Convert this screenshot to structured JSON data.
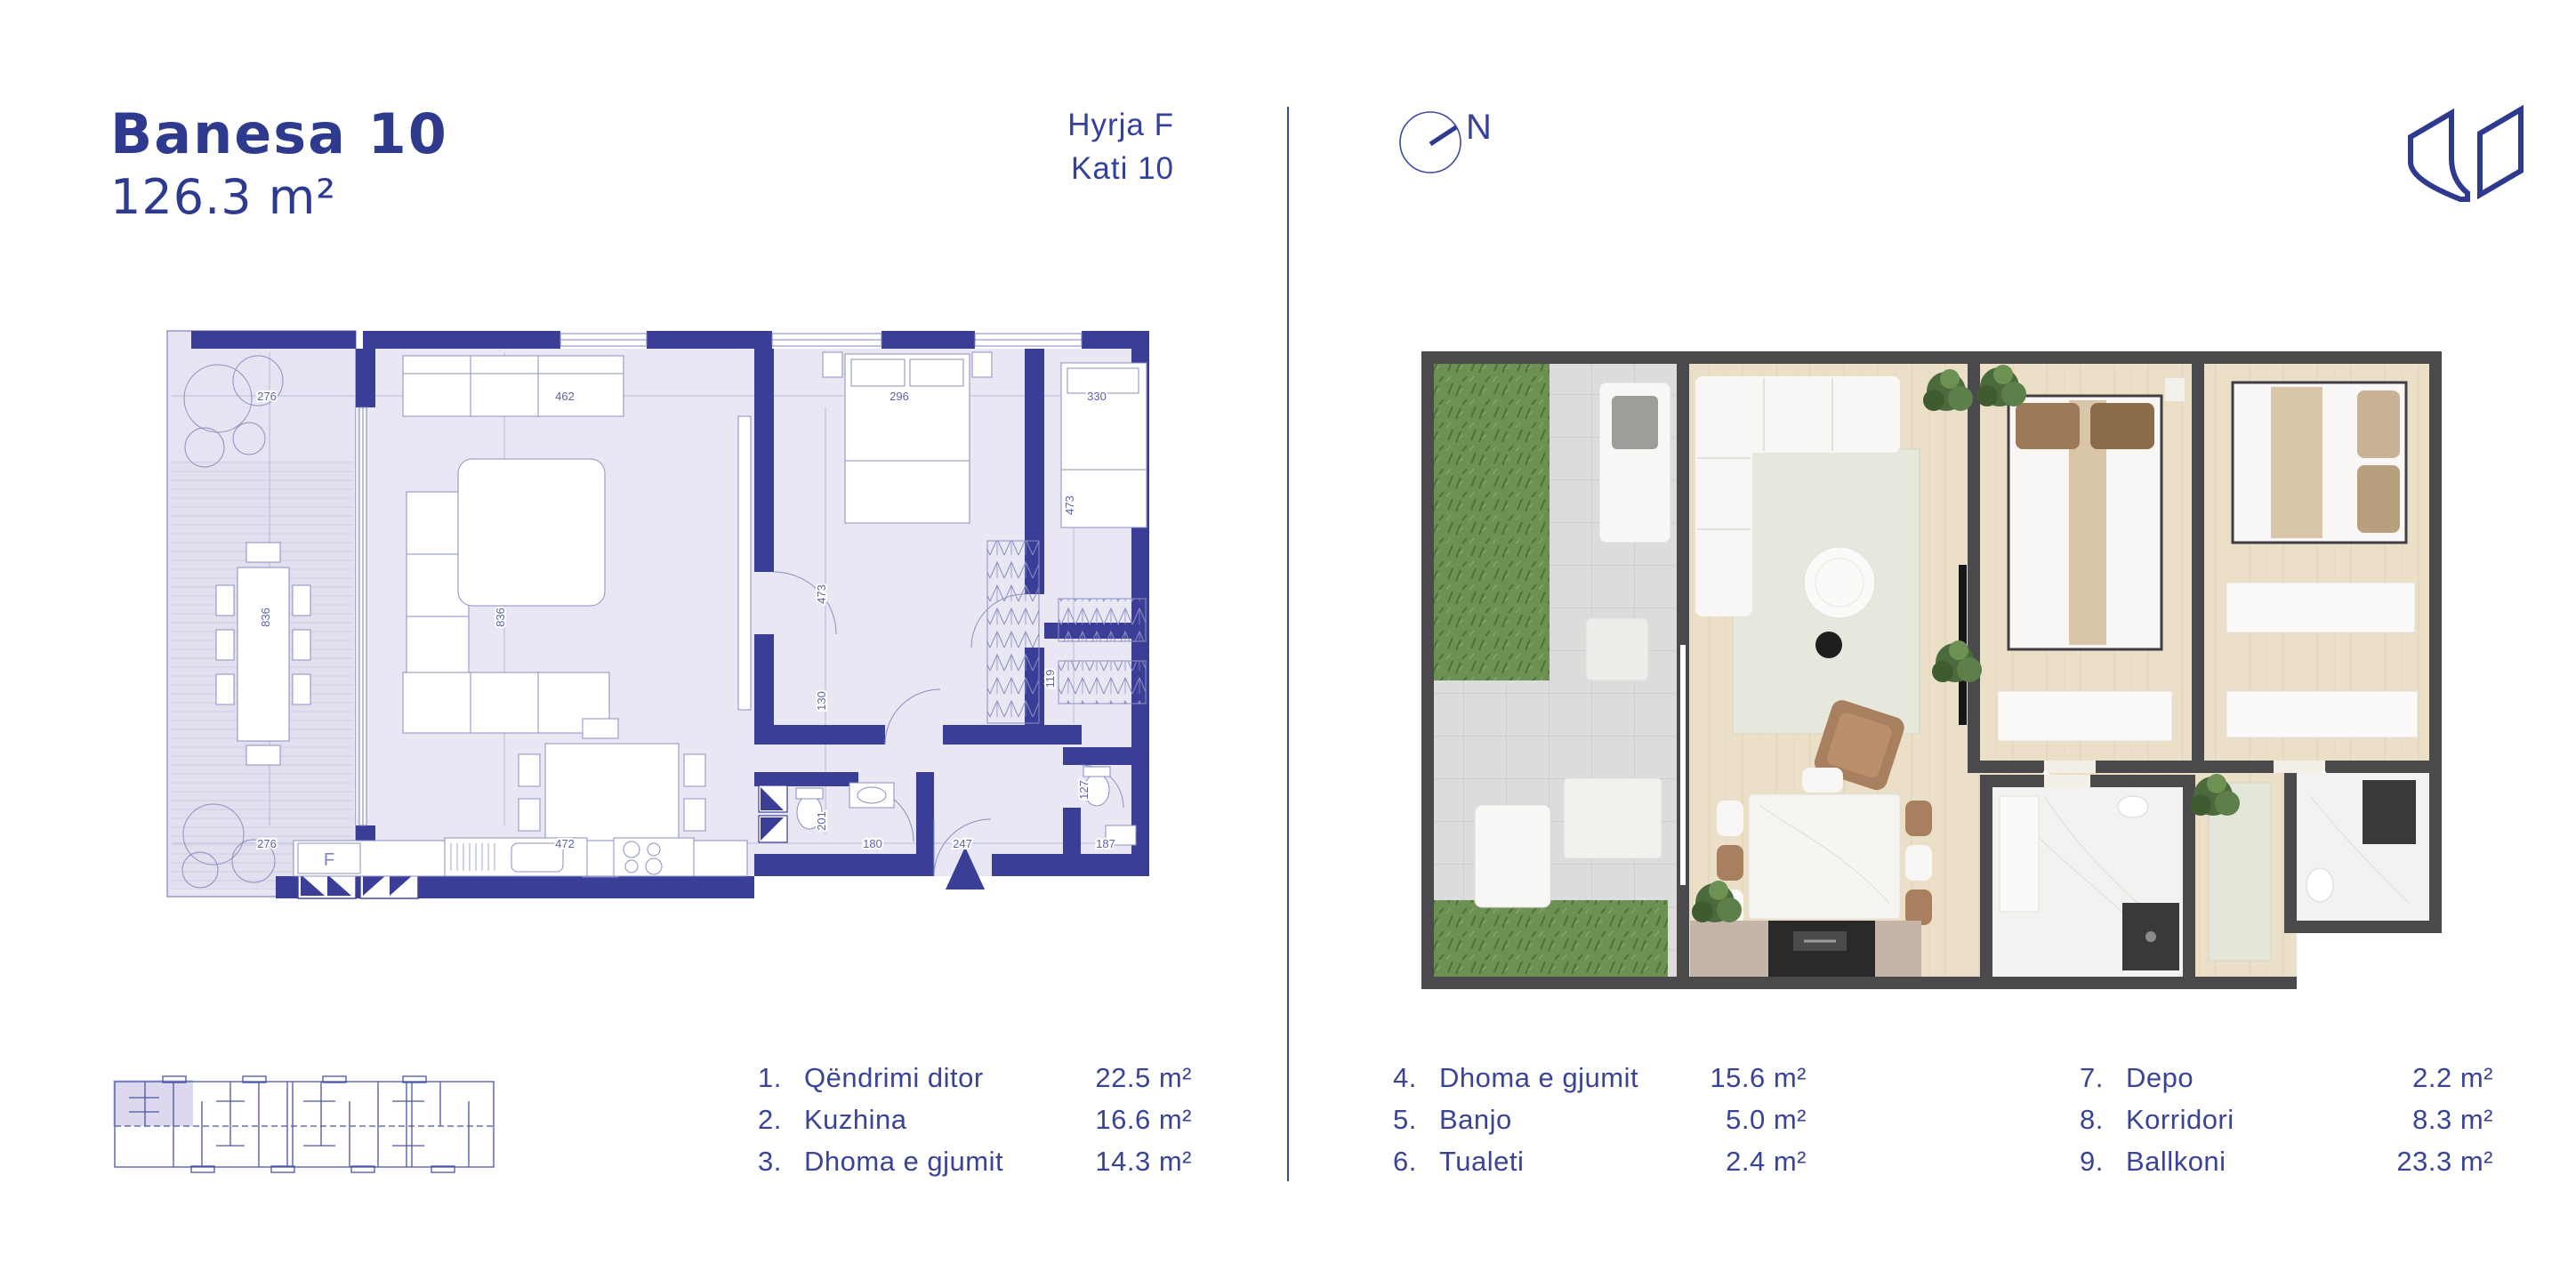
{
  "header": {
    "title": "Banesa 10",
    "area": "126.3 m²",
    "entrance": "Hyrja F",
    "floor": "Kati 10",
    "compass_label": "N"
  },
  "colors": {
    "brand_blue": "#2e3a8e",
    "text_blue": "#3a4496",
    "wall_blue": "#3a3e97",
    "plan_floor": "#e9e7f4",
    "render_wall": "#4a4a4c",
    "wood": "#ecdfc7",
    "tile": "#dcdcdd",
    "grass": "#6d9053",
    "marble": "#f3f2f0"
  },
  "plan2d": {
    "fridge_label": "F",
    "dims": {
      "t276": "276",
      "t462": "462",
      "t296": "296",
      "t330": "330",
      "b276": "276",
      "b472": "472",
      "b247": "247",
      "b180": "180",
      "b187": "187",
      "v836a": "836",
      "v836b": "836",
      "v473a": "473",
      "v473b": "473",
      "v130": "130",
      "v201": "201",
      "v119": "119",
      "v127": "127"
    }
  },
  "legend": {
    "columns": [
      {
        "items": [
          {
            "num": "1.",
            "name": "Qëndrimi ditor",
            "value": "22.5 m²"
          },
          {
            "num": "2.",
            "name": "Kuzhina",
            "value": "16.6 m²"
          },
          {
            "num": "3.",
            "name": "Dhoma e gjumit",
            "value": "14.3 m²"
          }
        ]
      },
      {
        "items": [
          {
            "num": "4.",
            "name": "Dhoma e gjumit",
            "value": "15.6 m²"
          },
          {
            "num": "5.",
            "name": "Banjo",
            "value": "5.0 m²"
          },
          {
            "num": "6.",
            "name": "Tualeti",
            "value": "2.4 m²"
          }
        ]
      },
      {
        "items": [
          {
            "num": "7.",
            "name": "Depo",
            "value": "2.2 m²"
          },
          {
            "num": "8.",
            "name": "Korridori",
            "value": "8.3 m²"
          },
          {
            "num": "9.",
            "name": "Ballkoni",
            "value": "23.3 m²"
          }
        ]
      }
    ]
  }
}
